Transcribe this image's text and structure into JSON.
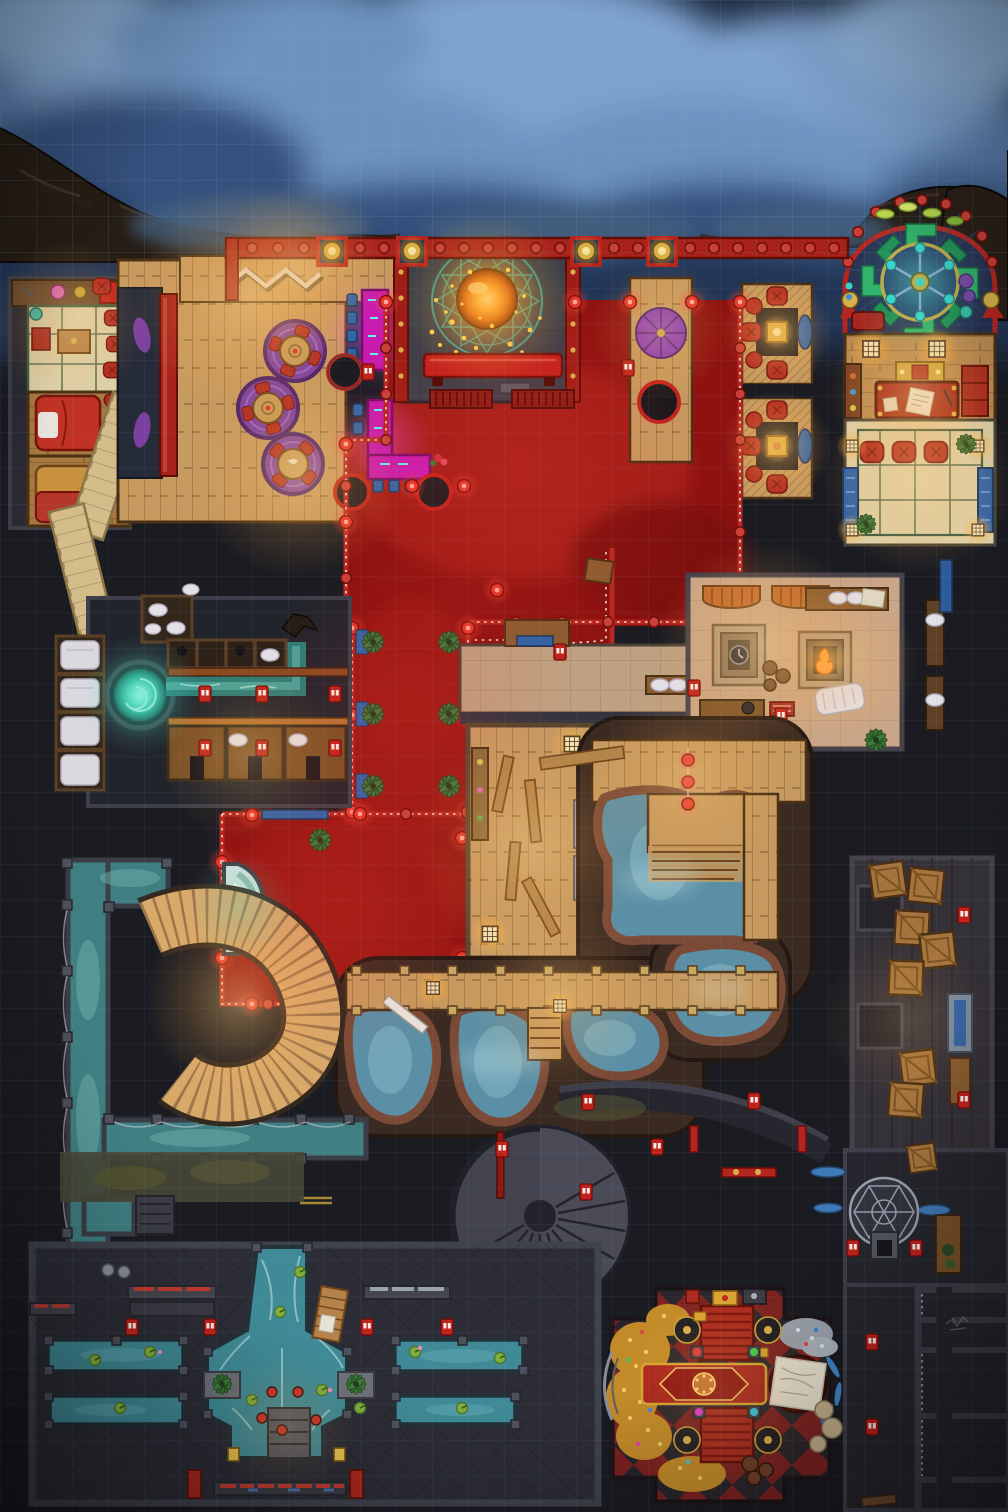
{
  "map": {
    "kind": "top-down fantasy TTRPG battlemap: night-time bathhouse / tavern / gambling den interior under steam clouds",
    "grid": {
      "cell_px": 36,
      "cols": 28,
      "rows": 42
    },
    "palette": {
      "stone_dark": "#1b1c22",
      "stone_mid": "#2e2f38",
      "wall": "#3e3f4a",
      "smoke_base": "#1d2a3f",
      "smoke_light": "#7fa3cf",
      "cliff": "#261d15",
      "wood_warm": "#c79a5f",
      "wood_dark": "#8a5c30",
      "red_carpet": "#8e1210",
      "red_bright": "#c1221c",
      "red_trim": "#b5251f",
      "lantern_red": "#e8352a",
      "accent_gold": "#c9a43a",
      "gold_coin": "#c28a28",
      "silver_coin": "#9aa2ac",
      "magenta_neon": "#c81bb0",
      "purple_rug": "#7b3fa0",
      "stage_slate": "#3a3f49",
      "teal_circle": "#2fa6a0",
      "orb_orange": "#f08018",
      "spring_water": "#5b8fa6",
      "canal_water": "#3f7f82",
      "river_water": "#3f8a96",
      "whirl_teal": "#3fc5a8",
      "tatami": "#ddd0a8",
      "tan_floor": "#c9a687",
      "checker_red": "#8e2626",
      "checker_dark": "#2e2a32",
      "moss": "#4a4a36",
      "plant_green": "#3e7a3a",
      "blue_accent": "#2f63a8"
    },
    "regions": [
      {
        "id": "smoke-clouds",
        "kind": "blue steam clouds over cliff, faint square grid"
      },
      {
        "id": "cliff-edge",
        "kind": "dark rocky ledge above the building"
      },
      {
        "id": "quarters-top-left",
        "kind": "tatami room, shelf, two beds"
      },
      {
        "id": "entrance-porch",
        "kind": "wood floor with zig-zag ramp, lantern wall"
      },
      {
        "id": "main-tavern-hall",
        "kind": "plank floor, 3 round tables on purple rugs, red bar"
      },
      {
        "id": "neon-reception-counters",
        "kind": "glowing magenta counters, blue stools, round black tables"
      },
      {
        "id": "stage-summoning-circle",
        "kind": "slate stage, teal ritual circle, glowing orange orb, red bench"
      },
      {
        "id": "red-carpet-hall",
        "kind": "red carpet with dotted trim, knob posts, glowing red lanterns"
      },
      {
        "id": "vip-booths",
        "kind": "two private booths: gold table, red cushions, blue mat"
      },
      {
        "id": "stained-glass-shrine",
        "kind": "arched chamber, green pinwheel mosaic, gold wheel medallion"
      },
      {
        "id": "office",
        "kind": "red desk with papers, gold shrine, window lamps, cabinets"
      },
      {
        "id": "tatami-lounge",
        "kind": "mats, three red cushions, blue side benches, corner lamps"
      },
      {
        "id": "fireside-lounge",
        "kind": "tan floor, two square fire pits, awnings, towels, benches"
      },
      {
        "id": "changing-stalls",
        "kind": "cubicles with towels, futon bays, whirlpool basin, dragon spout channel"
      },
      {
        "id": "sauna-changing-room",
        "kind": "wood room, loose benches, paper floor lamps, shelves"
      },
      {
        "id": "hot-spring-pools",
        "kind": "organic blue pools in red-brown rock, boardwalks, lantern string"
      },
      {
        "id": "cold-water-canal",
        "kind": "L-shaped teal channel with posts and rope"
      },
      {
        "id": "grand-spiral-stair",
        "kind": "wide wooden S-curve staircase, warm lit"
      },
      {
        "id": "fountain-lobby",
        "kind": "red carpet lobby, corner water fountain, fern planters"
      },
      {
        "id": "storage-corridor",
        "kind": "plank floor, scattered crates, counter, bench"
      },
      {
        "id": "lower-spiral-stair",
        "kind": "stone stair rotunda"
      },
      {
        "id": "dome-shrine",
        "kind": "geodesic dome frame, altar, blue puddles, shelf"
      },
      {
        "id": "bath-hall",
        "kind": "cross-shaped river with lily pads, four side pools, weapon racks"
      },
      {
        "id": "treasure-den",
        "kind": "red/black diamond floor, coin piles, four gaming tables, rug, map table"
      },
      {
        "id": "prison-cells",
        "kind": "cell row with chain marks and faint graffiti scratch"
      }
    ],
    "icons": [
      "door-marker",
      "red-lantern",
      "gold-wall-lantern",
      "paper-floor-lamp",
      "fern-planter",
      "wooden-crate",
      "red-cushion",
      "towel",
      "blue-stool",
      "lily-pad",
      "gem-pedestal",
      "dragon-spout",
      "whirlpool",
      "graffiti-scratch"
    ]
  }
}
